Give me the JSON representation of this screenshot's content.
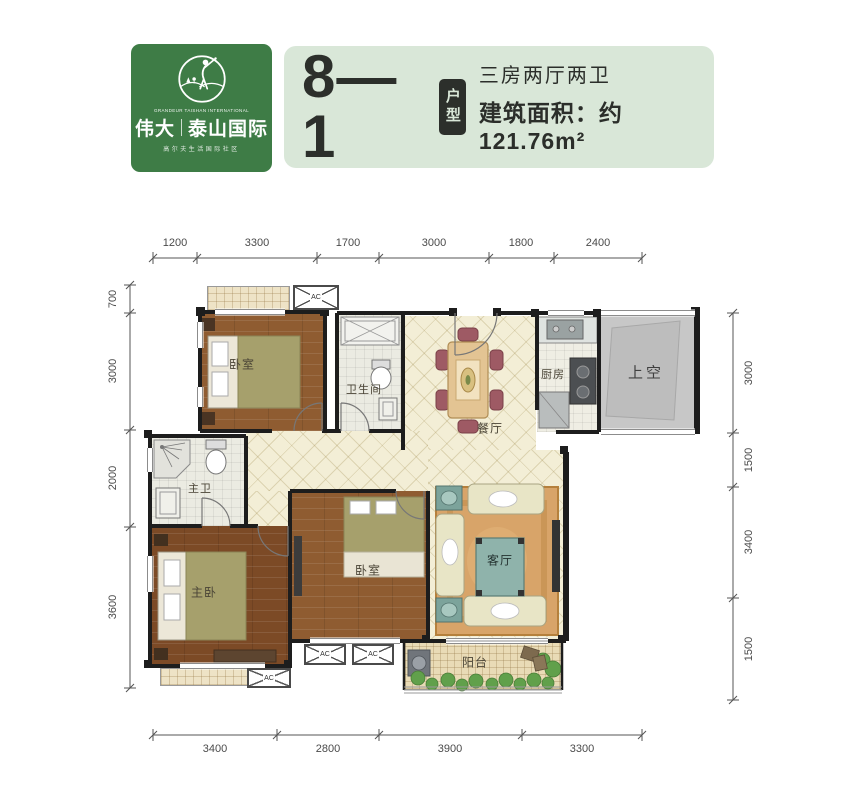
{
  "header": {
    "logo": {
      "brand_primary": "伟大",
      "brand_secondary": "泰山国际",
      "english_line": "GRANDEUR TAISHAN INTERNATIONAL",
      "tagline": "高尔夫生活国际社区",
      "bg_color": "#3e7c46"
    },
    "banner": {
      "bg_color": "#d9e7d8",
      "unit_number": "8—1",
      "unit_badge": "户型",
      "layout_type": "三房两厅两卫",
      "area_text": "建筑面积：约121.76m²"
    }
  },
  "floorplan": {
    "wall_color": "#1d1d1d",
    "rooms": {
      "bedroom_top": "卧室",
      "bathroom": "卫生间",
      "dining": "餐厅",
      "kitchen": "厨房",
      "void_above": "上空",
      "master_bath": "主卫",
      "master_bedroom": "主卧",
      "bedroom_middle": "卧室",
      "living": "客厅",
      "balcony": "阳台"
    },
    "ac_label": "AC",
    "dimensions_mm": {
      "top": [
        "1200",
        "3300",
        "1700",
        "3000",
        "1800",
        "2400"
      ],
      "bottom": [
        "3400",
        "2800",
        "3900",
        "3300"
      ],
      "left": [
        "700",
        "3000",
        "2000",
        "3600"
      ],
      "right": [
        "3000",
        "1500",
        "3400",
        "1500"
      ]
    }
  }
}
